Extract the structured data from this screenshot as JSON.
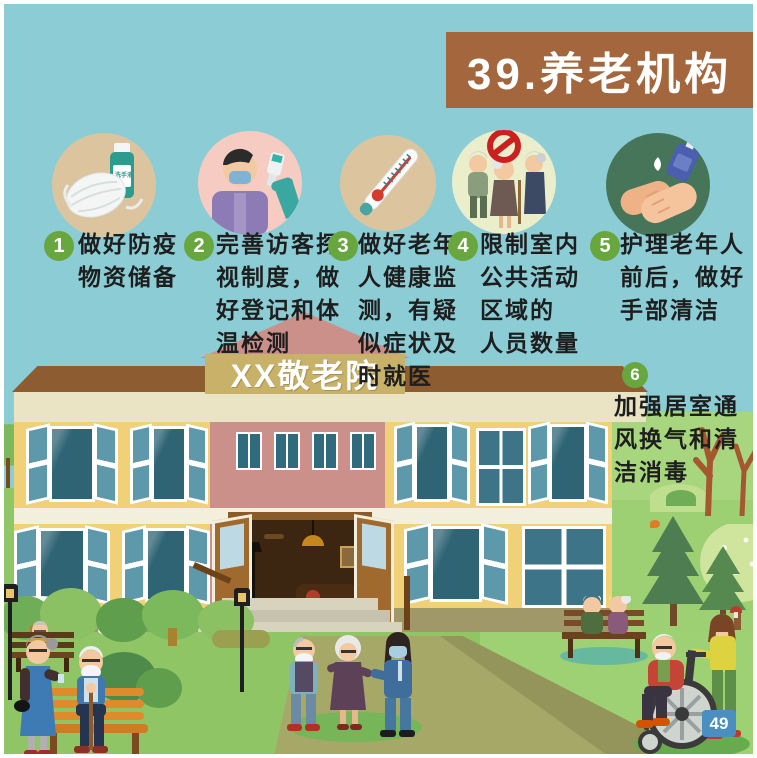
{
  "title": "39.养老机构",
  "building_sign": "XX敬老院",
  "page_number": "49",
  "sanitizer_label": "洗手液",
  "steps": [
    {
      "num": "1",
      "text": "做好防疫\n物资储备",
      "icon": "mask-and-sanitizer-icon"
    },
    {
      "num": "2",
      "text": "完善访客探\n视制度，做\n好登记和体\n温检测",
      "icon": "visitor-temperature-check-icon"
    },
    {
      "num": "3",
      "text": "做好老年\n人健康监\n测，有疑\n似症状及\n时就医",
      "icon": "thermometer-icon"
    },
    {
      "num": "4",
      "text": "限制室内\n公共活动\n区域的\n人员数量",
      "icon": "no-gathering-icon"
    },
    {
      "num": "5",
      "text": "护理老年人\n前后，做好\n手部清洁",
      "icon": "hand-hygiene-icon"
    },
    {
      "num": "6",
      "text": "加强居室通\n风换气和清\n洁消毒",
      "icon": "ventilation"
    }
  ],
  "colors": {
    "sky": "#8ccdd5",
    "title_banner": "#a4673d",
    "step_number_green": "#68a63e",
    "building_yellow": "#f1d178",
    "building_pink": "#ca9089",
    "roof_brown": "#8d5c30",
    "sign_tan": "#c8b168",
    "window_teal": "#2e6474",
    "grass_green": "#8fc565",
    "path_olive": "#a6a868",
    "badge_blue": "#4a8fc0",
    "prohibition_red": "#cc1f1f",
    "hand_circle_green": "#47755a"
  }
}
